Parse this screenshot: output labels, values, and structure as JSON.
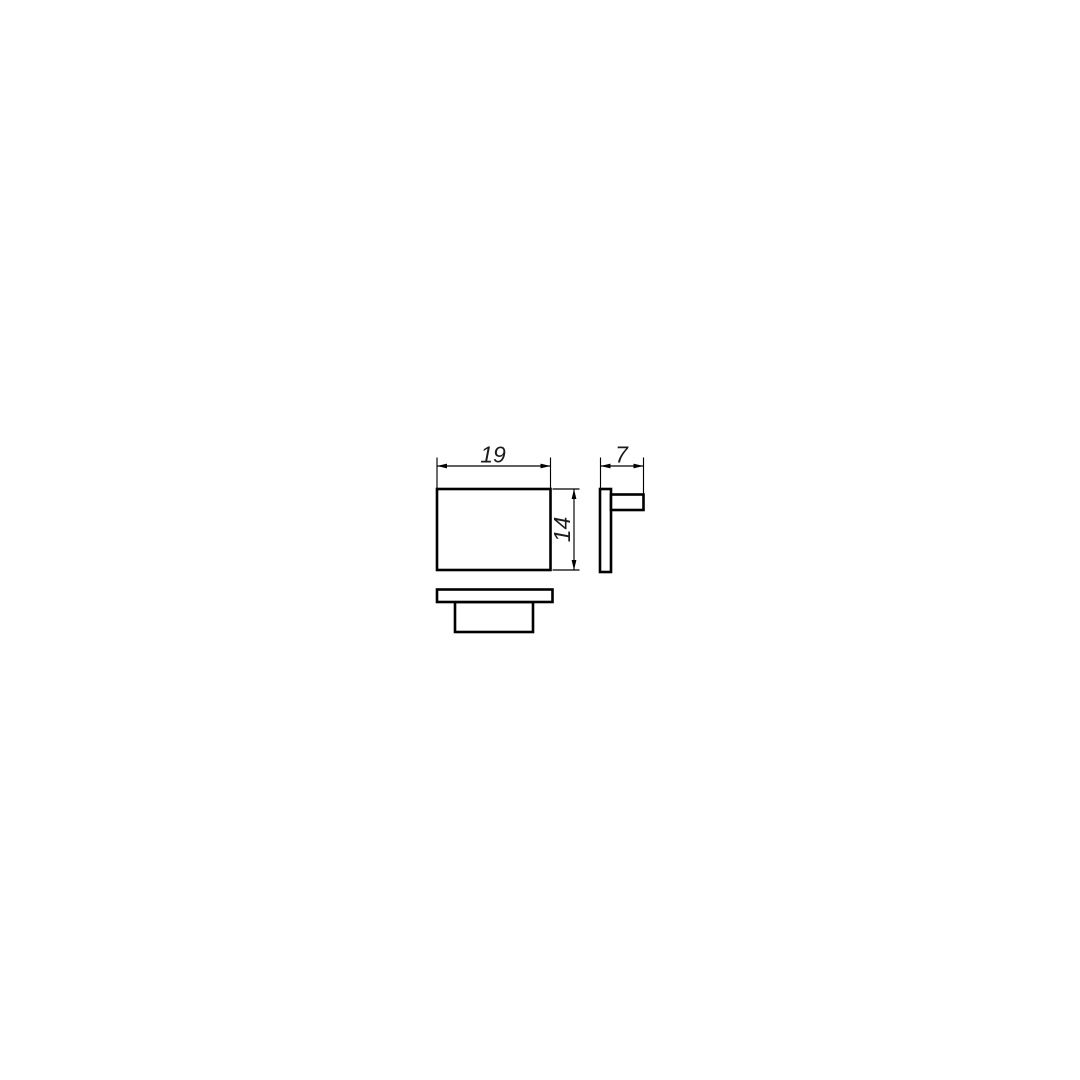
{
  "page": {
    "background": "#ffffff",
    "line_color": "#000000",
    "text_color": "#1c1c1c"
  },
  "drawing": {
    "kind": "orthographic-projection-technical-drawing",
    "views": {
      "front": {
        "name": "front-view",
        "shape": "rectangle"
      },
      "side": {
        "name": "side-view",
        "shape": "plate-with-boss"
      },
      "top": {
        "name": "top-view",
        "shape": "plate-with-boss"
      }
    },
    "dimensions": {
      "width": {
        "value": "19",
        "orientation": "horizontal",
        "view": "front"
      },
      "height": {
        "value": "14",
        "orientation": "vertical",
        "view": "front"
      },
      "depth": {
        "value": "7",
        "orientation": "horizontal",
        "view": "side"
      }
    }
  }
}
